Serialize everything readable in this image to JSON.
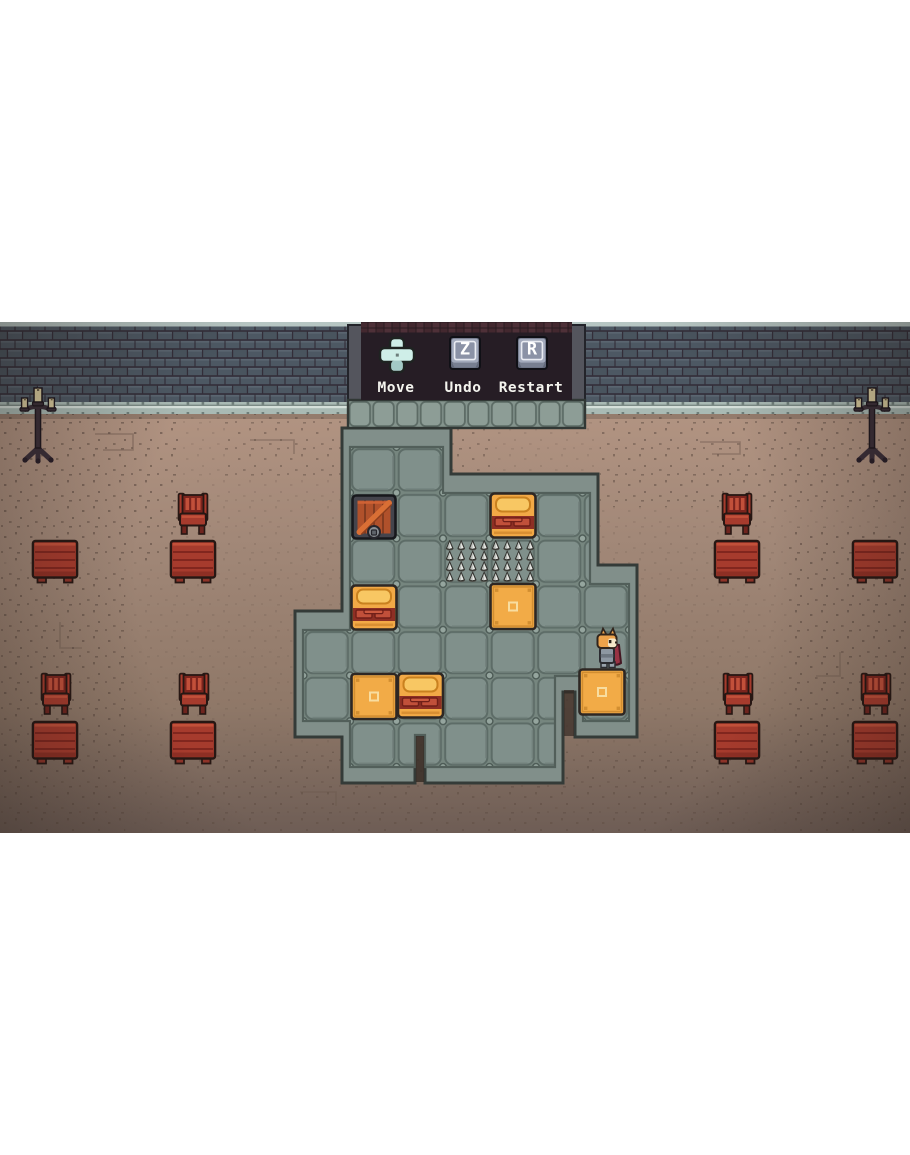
{
  "panel": {
    "controls": [
      {
        "label": "Move",
        "icon": "dpad-icon",
        "key": ""
      },
      {
        "label": "Undo",
        "icon": "key-icon",
        "key": "Z"
      },
      {
        "label": "Restart",
        "icon": "key-icon",
        "key": "R"
      }
    ]
  },
  "game": {
    "scene": "stone-room sokoban puzzle in a tavern",
    "player": {
      "sprite": "fox-knight",
      "position": "right wing of room, above orange crate"
    },
    "entities": {
      "orange_crates": 3,
      "beds": 3,
      "locked_wooden_crate": 1,
      "spike_tiles": 2,
      "tables": 8,
      "chairs": 6,
      "candelabras": 2
    }
  },
  "colors": {
    "page_background": "#ffffff",
    "wall_brick": "#4d5863",
    "wall_mortar": "#332e39",
    "wall_trim": "#b7c6c3",
    "baseboard": "#a9bab4",
    "floor": "#a28878",
    "floor_dark": "#74625a",
    "room_tile": "#7e8e89",
    "tile_groove": "#5d6c67",
    "room_outline": "#343b38",
    "panel_background": "#261d25",
    "key_face": "#a2a9bb",
    "dpad": "#cfeee8",
    "crate_orange": "#f2ab47",
    "bed_band_red": "#8e2f24",
    "furniture_red": "#a63b2d",
    "fox_fur": "#eda24b",
    "fox_cape": "#993344",
    "spike": "#e9e9e5",
    "label_text": "#f4f4ee"
  }
}
